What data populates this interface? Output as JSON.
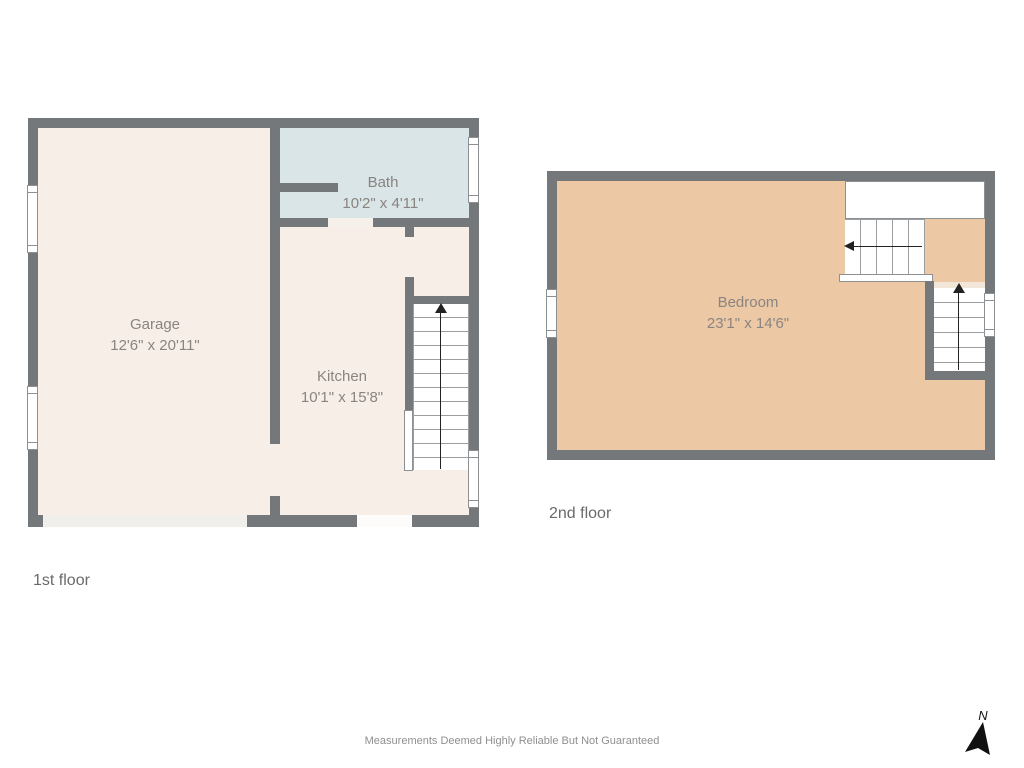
{
  "floors": {
    "first": {
      "caption": "1st floor",
      "rooms": {
        "garage": {
          "name": "Garage",
          "dims": "12'6\" x 20'11\""
        },
        "bath": {
          "name": "Bath",
          "dims": "10'2\" x 4'11\""
        },
        "kitchen": {
          "name": "Kitchen",
          "dims": "10'1\" x 15'8\""
        }
      }
    },
    "second": {
      "caption": "2nd floor",
      "rooms": {
        "bedroom": {
          "name": "Bedroom",
          "dims": "23'1\" x 14'6\""
        }
      }
    }
  },
  "footer": {
    "disclaimer": "Measurements Deemed Highly Reliable But Not Guaranteed"
  },
  "compass": {
    "label": "N"
  },
  "colors": {
    "wall": "#75787a",
    "floor_light": "#f7eee8",
    "bath": "#d9e5e6",
    "bedroom": "#ecc8a5",
    "threshold": "#f1efeb",
    "door_gap": "#f5f1ea",
    "stair_line": "#9b9ea1",
    "outline": "#8d9092",
    "arrow": "#222222",
    "room_label": "#8a8480",
    "caption": "#6a6a6a",
    "disclaimer": "#8f8f8f"
  }
}
